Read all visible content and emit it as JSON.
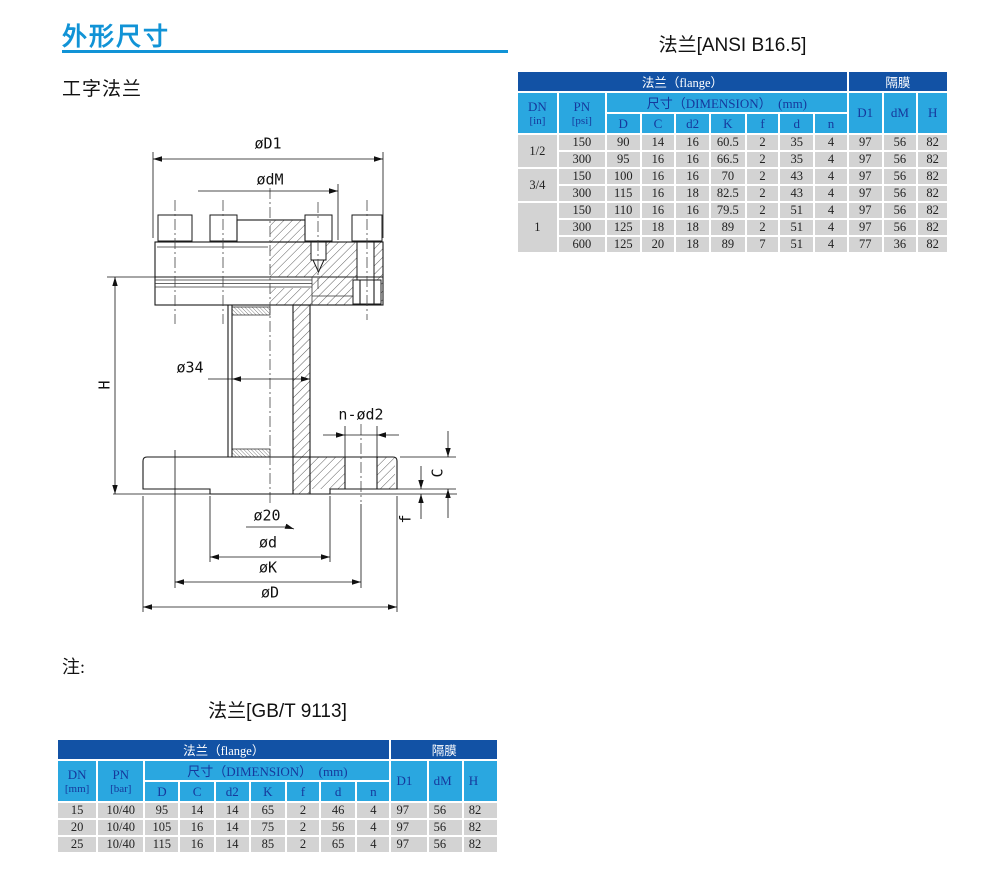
{
  "colors": {
    "accent": "#1193d6",
    "table-band": "#1252a5",
    "table-header": "#2aa7e0",
    "table-header-text": "#16389c",
    "table-row": "#d3d3d3",
    "ink": "#1a1a1a"
  },
  "page": {
    "section_title": "外形尺寸",
    "product_subtitle": "工字法兰",
    "note_label": "注:"
  },
  "drawing": {
    "labels": {
      "d1": "øD1",
      "dm": "ødM",
      "bore34": "ø34",
      "n_d2": "n-ød2",
      "d20": "ø20",
      "d": "ød",
      "k": "øK",
      "big_d": "øD",
      "h": "H",
      "c": "C",
      "f": "f"
    }
  },
  "ansi_table": {
    "title": "法兰[ANSI B16.5]",
    "header": {
      "flange_group": "法兰（flange）",
      "diaphragm_group": "隔膜",
      "dn_label": "DN",
      "dn_unit": "[in]",
      "pn_label": "PN",
      "pn_unit": "[psi]",
      "dimension_label": "尺寸（DIMENSION）　(mm)",
      "dim_cols": [
        "D",
        "C",
        "d2",
        "K",
        "f",
        "d",
        "n"
      ],
      "diaphragm_cols": [
        "D1",
        "dM",
        "H"
      ]
    },
    "groups": [
      {
        "dn": "1/2",
        "rows": [
          [
            "150",
            "90",
            "14",
            "16",
            "60.5",
            "2",
            "35",
            "4",
            "97",
            "56",
            "82"
          ],
          [
            "300",
            "95",
            "16",
            "16",
            "66.5",
            "2",
            "35",
            "4",
            "97",
            "56",
            "82"
          ]
        ]
      },
      {
        "dn": "3/4",
        "rows": [
          [
            "150",
            "100",
            "16",
            "16",
            "70",
            "2",
            "43",
            "4",
            "97",
            "56",
            "82"
          ],
          [
            "300",
            "115",
            "16",
            "18",
            "82.5",
            "2",
            "43",
            "4",
            "97",
            "56",
            "82"
          ]
        ]
      },
      {
        "dn": "1",
        "rows": [
          [
            "150",
            "110",
            "16",
            "16",
            "79.5",
            "2",
            "51",
            "4",
            "97",
            "56",
            "82"
          ],
          [
            "300",
            "125",
            "18",
            "18",
            "89",
            "2",
            "51",
            "4",
            "97",
            "56",
            "82"
          ],
          [
            "600",
            "125",
            "20",
            "18",
            "89",
            "7",
            "51",
            "4",
            "77",
            "36",
            "82"
          ]
        ]
      }
    ]
  },
  "gbt_table": {
    "title": "法兰[GB/T 9113]",
    "header": {
      "flange_group": "法兰（flange）",
      "diaphragm_group": "隔膜",
      "dn_label": "DN",
      "dn_unit": "[mm]",
      "pn_label": "PN",
      "pn_unit": "[bar]",
      "dimension_label": "尺寸（DIMENSION）　(mm)",
      "dim_cols": [
        "D",
        "C",
        "d2",
        "K",
        "f",
        "d",
        "n"
      ],
      "diaphragm_cols": [
        "D1",
        "dM",
        "H"
      ]
    },
    "rows": [
      [
        "15",
        "10/40",
        "95",
        "14",
        "14",
        "65",
        "2",
        "46",
        "4",
        "97",
        "56",
        "82"
      ],
      [
        "20",
        "10/40",
        "105",
        "16",
        "14",
        "75",
        "2",
        "56",
        "4",
        "97",
        "56",
        "82"
      ],
      [
        "25",
        "10/40",
        "115",
        "16",
        "14",
        "85",
        "2",
        "65",
        "4",
        "97",
        "56",
        "82"
      ]
    ]
  }
}
